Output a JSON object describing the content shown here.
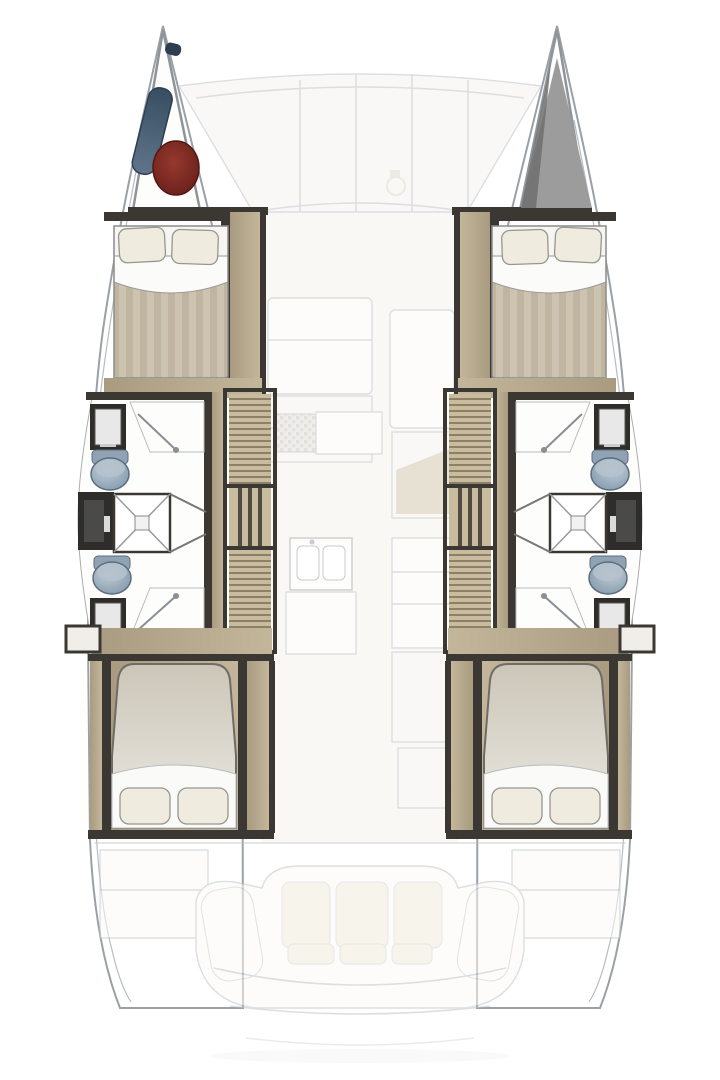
{
  "plan": {
    "type": "catamaran-floorplan-top-view",
    "hulls": 2,
    "cabins": [
      "port-forward-cabin",
      "port-aft-cabin",
      "starboard-forward-cabin",
      "starboard-aft-cabin"
    ],
    "heads": [
      "port-forward-head",
      "port-aft-head",
      "starboard-forward-head",
      "starboard-aft-head"
    ],
    "showers": [
      "port-mid-shower",
      "starboard-mid-shower"
    ],
    "stairs": [
      "port-companionway-stairs",
      "starboard-companionway-stairs"
    ],
    "features": [
      "port-bow-locker-with-fenders",
      "starboard-bow-locker",
      "foredeck-panels",
      "salon-seating",
      "galley-stove",
      "galley-sink-island",
      "salon-table",
      "aft-cockpit-sofa",
      "cockpit-side-benches",
      "transom-steps"
    ],
    "port_bow_gear": [
      "fender-blue",
      "buoy-red"
    ]
  },
  "colors": {
    "hull-stroke": "#9aa0a6",
    "ghost": "#c2c4c8",
    "ghost-fill": "#f5f3ee",
    "wall": "#3b3833",
    "wood": "#a89b80",
    "wood-light": "#c3b69b",
    "bed-stripe-a": "#cdc3b1",
    "bed-stripe-b": "#c0b5a1",
    "linen": "#efebdf",
    "sheet": "#fbfbfa",
    "aft-bed": "#d8d3c8",
    "toilet": "#8fa3b5",
    "fixture-dark": "#2f2d2a",
    "buoy-red": "#7b2721",
    "fender-blue": "#4d6379",
    "locker-gray": "#9c9c9c",
    "locker-shadow": "#6f6f6f",
    "cushion": "#f0ead9",
    "table": "#ab9f90"
  }
}
